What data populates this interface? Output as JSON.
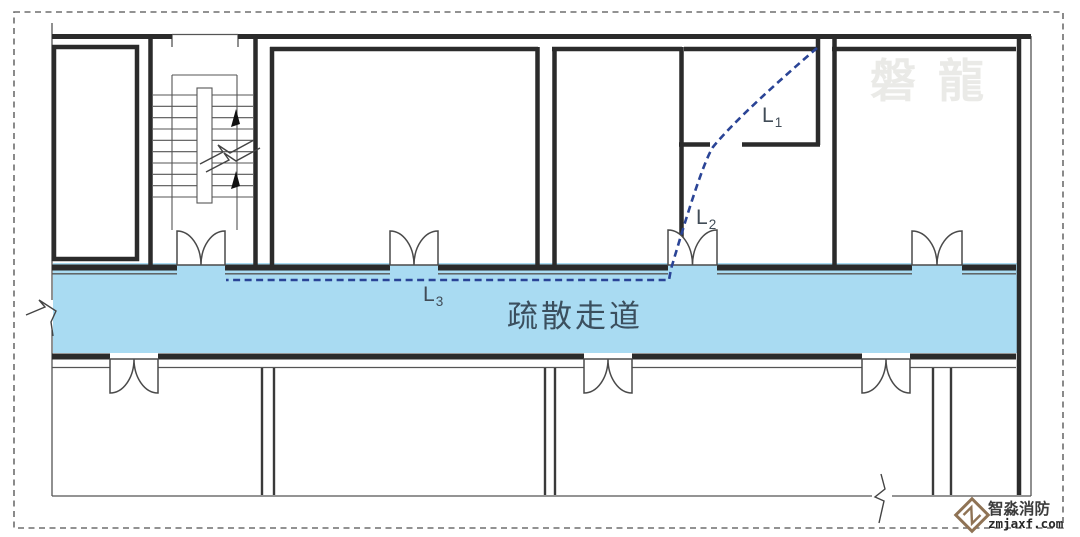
{
  "floor_plan": {
    "corridor": {
      "label": "疏散走道",
      "fill": "#a9dbf2",
      "label_color": "#3b4f5e"
    },
    "route": {
      "color": "#2a4496",
      "labels": [
        {
          "base": "L",
          "sub": "1"
        },
        {
          "base": "L",
          "sub": "2"
        },
        {
          "base": "L",
          "sub": "3"
        }
      ]
    },
    "watermark": {
      "text": "磐龍",
      "color": "#eaeae7"
    },
    "brand": {
      "name": "智淼消防",
      "domain": "zmjaxf.com",
      "icon_color": "#8f7355"
    }
  }
}
